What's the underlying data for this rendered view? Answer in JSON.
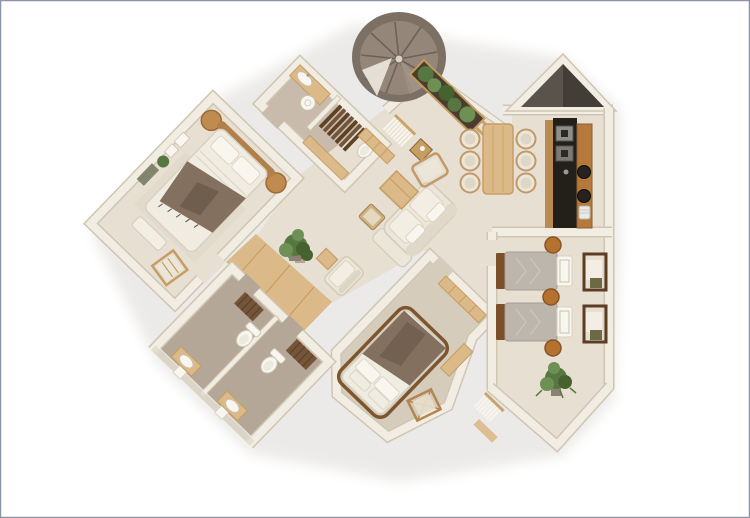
{
  "meta": {
    "description": "3D rendered top-down floor plan of an apartment, beige minimalist style, rotated wings, on white background with thin blue-grey border",
    "background": "#ffffff"
  },
  "palette": {
    "border": "#8a96a8",
    "wall": "#f2ede3",
    "wallEdge": "#cfc5b2",
    "wallShadow": "#5a534c",
    "wallShadowDark": "#433d37",
    "floor": "#e6dfd2",
    "bedroomFloor": "#d6ccbc",
    "bathFloor": "#b5a797",
    "bathFloorLight": "#c8bbac",
    "wood": "#dcb988",
    "woodMid": "#c69d63",
    "woodDark": "#8a5f33",
    "woodDeep": "#5d4226",
    "stair": "#948678",
    "stairRing": "#7c6f64",
    "stairDark": "#6e6156",
    "stairLight": "#a2948a",
    "counter": "#232019",
    "steel": "#8e8e8c",
    "green": "#577742",
    "greenLight": "#6f9055",
    "greenDark": "#46632f",
    "fabric": "#ece6d8",
    "fabricEdge": "#d4cbb8",
    "linen": "#f2eee3",
    "blanket": "#84705e",
    "blanketDark": "#5f4f41",
    "duvetGray": "#bdb6ad",
    "duvetGrayEdge": "#a59d93",
    "white": "#f8f6ef",
    "shadow": "#8b8274"
  },
  "rooms": [
    {
      "id": "master-bedroom",
      "wing": "upper-left, rotated",
      "furniture": [
        "double-bed",
        "curved-headboard",
        "round-nightstand",
        "round-nightstand",
        "brown-throw-blanket",
        "foot-bench",
        "folding-lounge-chair",
        "wall-frames",
        "wall-plant"
      ]
    },
    {
      "id": "upper-bathroom",
      "wing": "top-center, rotated",
      "furniture": [
        "vanity-counter",
        "oval-sink",
        "vessel-basin",
        "wood-steps",
        "toilet",
        "wood-cabinet"
      ]
    },
    {
      "id": "spiral-staircase",
      "wing": "top-center",
      "furniture": [
        "spiral-stairs",
        "landing"
      ]
    },
    {
      "id": "balcony-planter",
      "wing": "top-center-right",
      "furniture": [
        "planter-box",
        "plants",
        "pergola-beams"
      ]
    },
    {
      "id": "living-room",
      "wing": "center",
      "furniture": [
        "sofa-with-chaise",
        "coffee-table",
        "pouf",
        "side-table",
        "armchair",
        "floor-plant",
        "entry-bench",
        "macrame-hanging"
      ]
    },
    {
      "id": "dining-area",
      "wing": "center-right",
      "furniture": [
        "dining-table",
        "dining-chair",
        "dining-chair",
        "dining-chair",
        "dining-chair",
        "dining-chair",
        "dining-chair"
      ]
    },
    {
      "id": "kitchen",
      "wing": "right, with pointed corner",
      "furniture": [
        "dark-counter",
        "cooktop",
        "cooktop",
        "wood-counter",
        "round-sink",
        "round-sink",
        "canister"
      ]
    },
    {
      "id": "hallway",
      "wing": "center-left",
      "furniture": [
        "wood-floor",
        "potted-plant",
        "cube-stool",
        "armchair"
      ]
    },
    {
      "id": "lower-bathrooms",
      "wing": "bottom-left, rotated, two stalls",
      "furniture": [
        "toilet",
        "toilet",
        "vanity-basin",
        "vanity-basin",
        "wood-mat",
        "wood-mat",
        "glass-wall-handles"
      ]
    },
    {
      "id": "second-bedroom",
      "wing": "bottom-center, rotated",
      "furniture": [
        "double-bed",
        "brown-duvet",
        "pillows",
        "wardrobe",
        "director-chair",
        "wall-shelf",
        "macrame-hanging"
      ]
    },
    {
      "id": "twin-bedroom",
      "wing": "right wing, pointed bottom",
      "furniture": [
        "single-bed",
        "single-bed",
        "round-stool",
        "round-stool",
        "round-stool",
        "desk-chair",
        "desk-chair",
        "potted-plant"
      ]
    }
  ]
}
